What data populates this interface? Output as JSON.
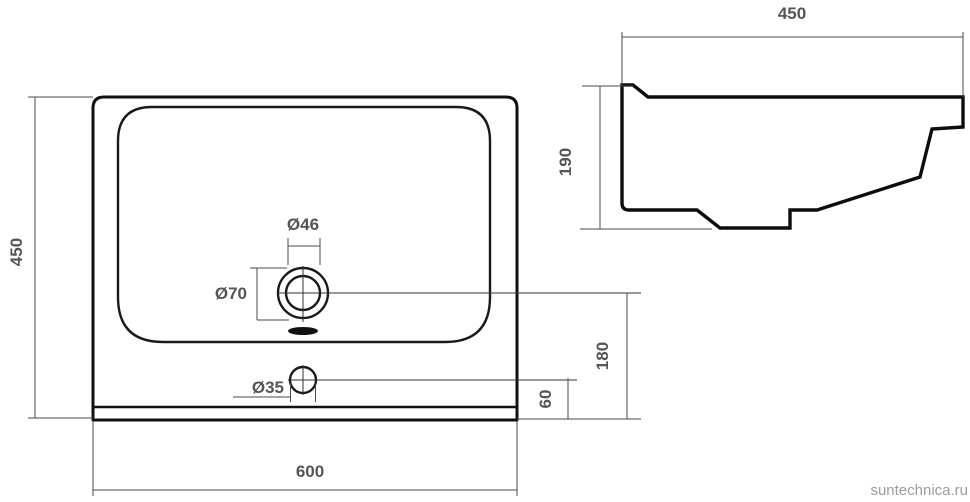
{
  "page": {
    "background": "#ffffff",
    "watermark": "suntechnica.ru"
  },
  "drawing": {
    "type": "technical-dimensional-diagram",
    "subject": "washbasin (sink) two-view dimensional drawing",
    "colors": {
      "outline": "#111111",
      "dimension_line": "#4a4a4a",
      "dimension_text": "#555555",
      "watermark_text": "#9c9c9c"
    },
    "front_view": {
      "dimensions": {
        "overall_width": "600",
        "overall_height": "450",
        "drain_outer_diameter": "Ø70",
        "drain_inner_diameter": "Ø46",
        "overflow_hole_diameter": "Ø35",
        "drain_center_to_bottom": "180",
        "overflow_center_to_bottom": "60"
      }
    },
    "side_view": {
      "dimensions": {
        "overall_depth": "450",
        "overall_height": "190"
      }
    }
  }
}
